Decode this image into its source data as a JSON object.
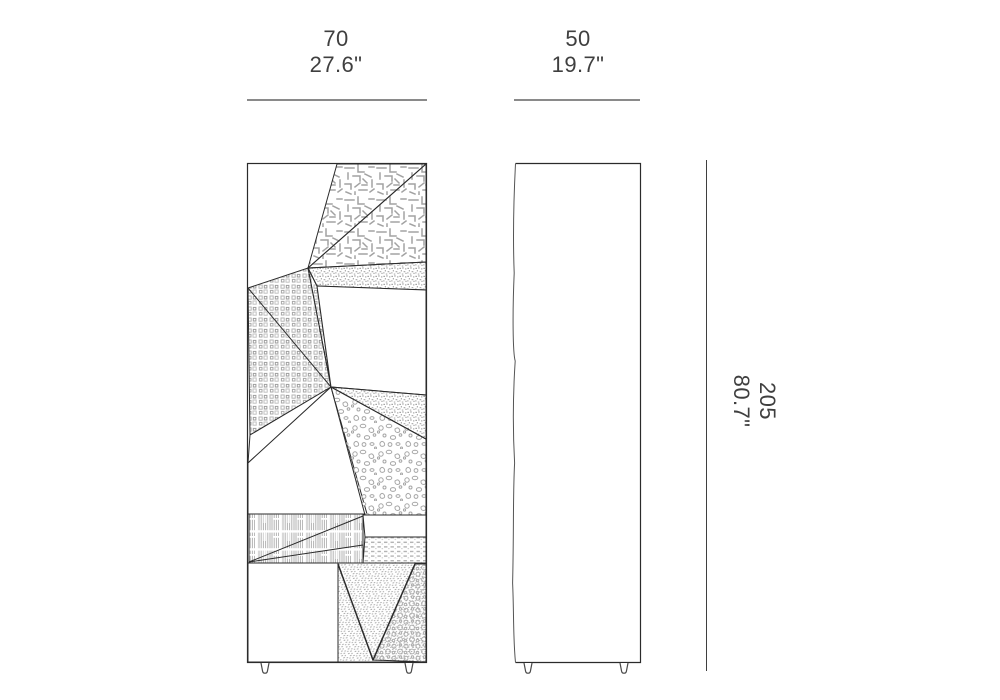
{
  "diagram": {
    "title": "cabinet-dimension-drawing",
    "views": [
      {
        "id": "front-view",
        "description": "front elevation with faceted patterned panels"
      },
      {
        "id": "side-view",
        "description": "side elevation"
      }
    ]
  },
  "dimensions": {
    "width": {
      "cm": "70",
      "inches": "27.6\""
    },
    "depth": {
      "cm": "50",
      "inches": "19.7\""
    },
    "height": {
      "cm": "205",
      "inches": "80.7\""
    }
  },
  "colors": {
    "background": "#ffffff",
    "drawing_outline": "#2b2b2b",
    "pattern_gray": "#a6a6a6",
    "dimension_line_horizontal": "#8a8a8a",
    "dimension_line_vertical": "#3f3f3f",
    "label_text": "#3f3f3f"
  }
}
